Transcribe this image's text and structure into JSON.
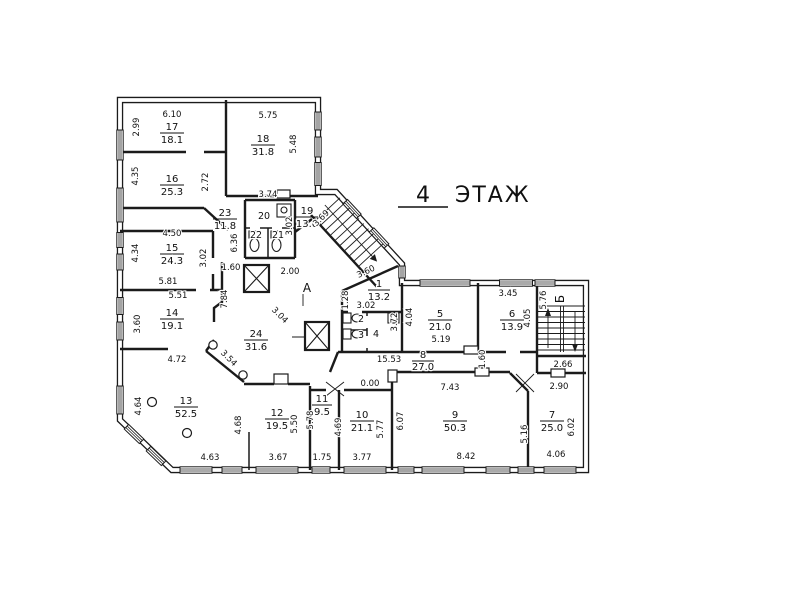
{
  "title": {
    "floor_number": "4",
    "floor_word": "ЭТАЖ"
  },
  "stairwells": {
    "a": "А",
    "b": "Б"
  },
  "rooms": {
    "r1": {
      "number": "1",
      "area": "13.2"
    },
    "r2": {
      "number": "2"
    },
    "r3": {
      "number": "3"
    },
    "r4": {
      "number": "4"
    },
    "r5": {
      "number": "5",
      "area": "21.0"
    },
    "r6": {
      "number": "6",
      "area": "13.9"
    },
    "r7": {
      "number": "7",
      "area": "25.0"
    },
    "r8": {
      "number": "8",
      "area": "27.0"
    },
    "r9": {
      "number": "9",
      "area": "50.3"
    },
    "r10": {
      "number": "10",
      "area": "21.1"
    },
    "r11": {
      "number": "11",
      "area": "9.5"
    },
    "r12": {
      "number": "12",
      "area": "19.5"
    },
    "r13": {
      "number": "13",
      "area": "52.5"
    },
    "r14": {
      "number": "14",
      "area": "19.1"
    },
    "r15": {
      "number": "15",
      "area": "24.3"
    },
    "r16": {
      "number": "16",
      "area": "25.3"
    },
    "r17": {
      "number": "17",
      "area": "18.1"
    },
    "r18": {
      "number": "18",
      "area": "31.8"
    },
    "r19": {
      "number": "19",
      "area": "13.0"
    },
    "r20": {
      "number": "20"
    },
    "r21": {
      "number": "21"
    },
    "r22": {
      "number": "22"
    },
    "r23": {
      "number": "23",
      "area": "11.8"
    },
    "r24": {
      "number": "24",
      "area": "31.6"
    }
  },
  "dims": {
    "d17_top": "6.10",
    "d17_left": "2.99",
    "d18_top": "5.75",
    "d18_right": "5.48",
    "d16_left": "4.35",
    "d16_right": "2.72",
    "d15_top": "4.50",
    "d15_left": "4.34",
    "d15_right": "3.02",
    "d15_bottom": "5.81",
    "d14_top": "5.51",
    "d14_left": "3.60",
    "d14_right": "7.84",
    "d14_bottom": "4.72",
    "d13_left": "4.64",
    "d13_bottom": "4.63",
    "d23_top": "3.74",
    "d23_left": "6.36",
    "d19_left": "3.02",
    "d19_diag": "3.69",
    "d24_lift": "1.60",
    "d24_hall": "2.00",
    "d24_diag1": "3.04",
    "d24_diag2": "3.54",
    "d1_left": "1.28",
    "d1_diag": "3.60",
    "d1_bottom": "3.02",
    "d4_right": "3.72",
    "d5_left": "4.04",
    "d5_bottom": "5.19",
    "d6_top": "3.45",
    "d6_right": "4.05",
    "d6_br": "1.60",
    "dB_left": "5.76",
    "dB_below": "2.66",
    "d7_top": "2.90",
    "d7_left": "5.16",
    "d7_bottom": "4.06",
    "d7_right": "6.02",
    "d8_len": "15.53",
    "d8_zero": "0.00",
    "d9_top": "7.43",
    "d9_left": "6.07",
    "d9_outer": "5.77",
    "d9_bottom": "8.42",
    "d12_left": "4.68",
    "d12_right": "5.50",
    "d12_bottom": "3.67",
    "d11_left": "5.78",
    "d11_bottom": "1.75",
    "d11_right": "4.69",
    "d10_bottom": "3.77"
  }
}
